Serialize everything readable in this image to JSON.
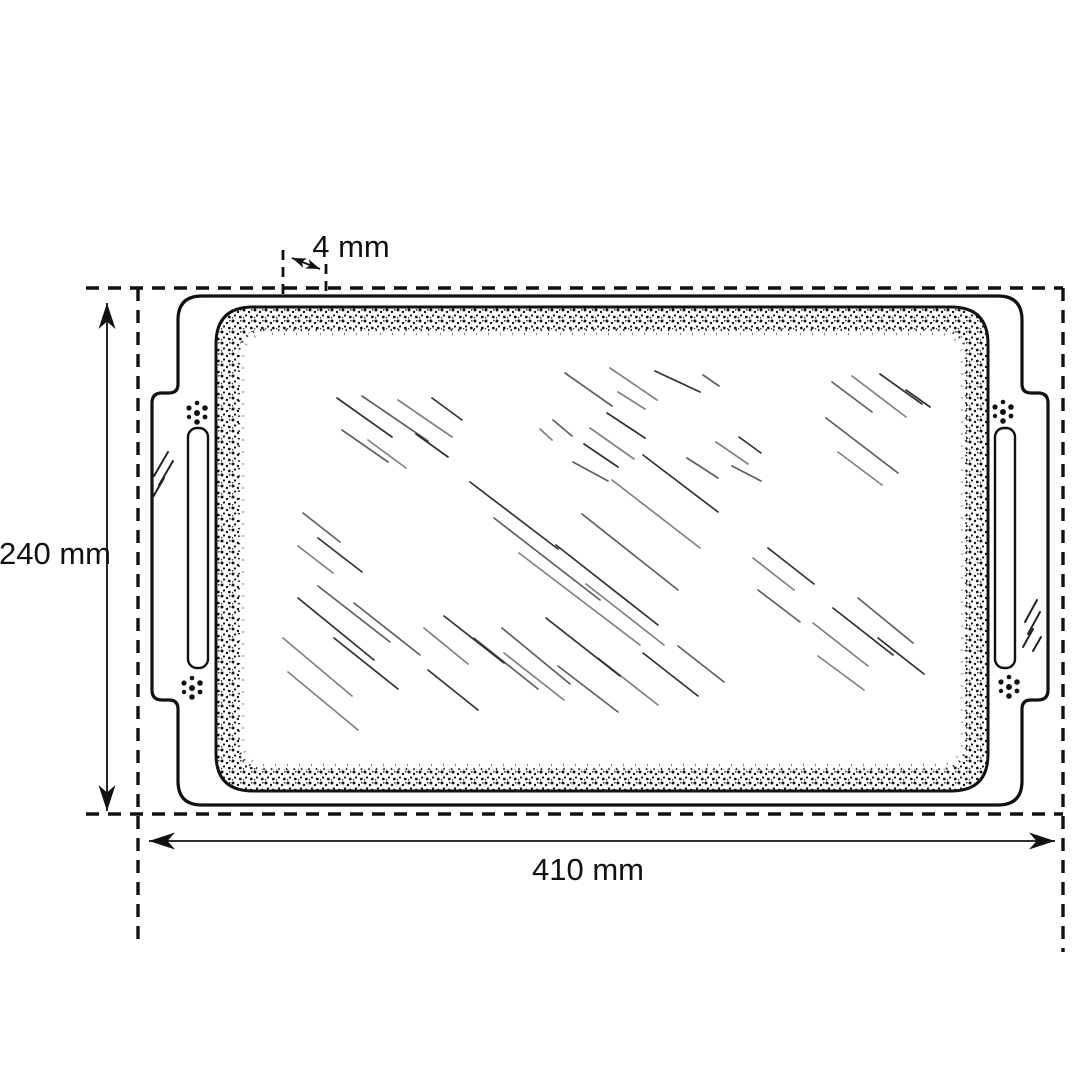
{
  "diagram": {
    "kind": "dimensioned technical line drawing",
    "subject": "rectangular glass serving tray with side handles, top view",
    "labels": {
      "height": "240 mm",
      "width": "410 mm",
      "rim_thickness": "4 mm"
    },
    "colors": {
      "ink": "#111111",
      "background": "#ffffff"
    }
  }
}
